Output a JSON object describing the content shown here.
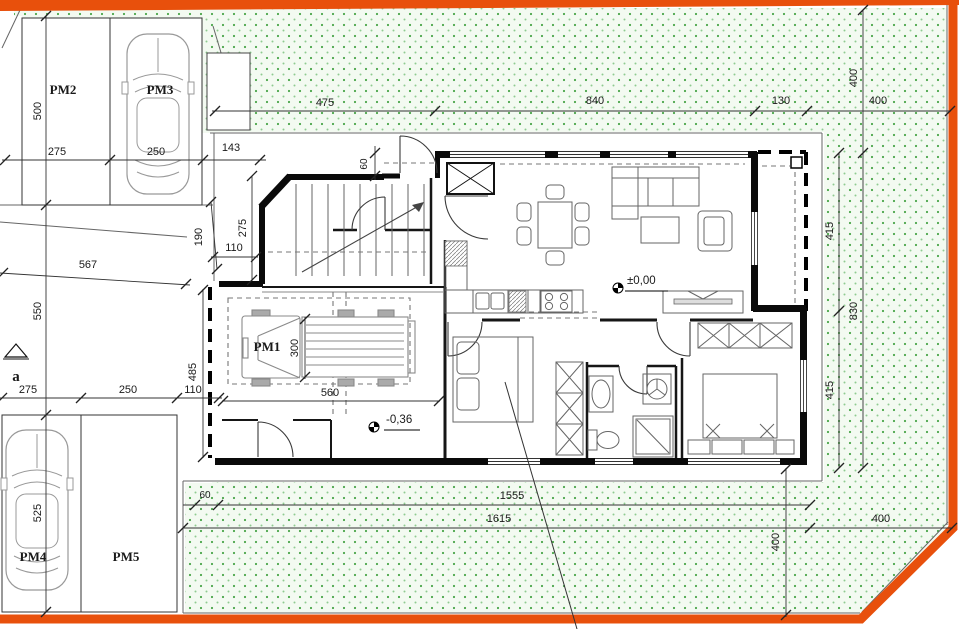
{
  "plan": {
    "parking_labels": {
      "pm1": "PM1",
      "pm2": "PM2",
      "pm3": "PM3",
      "pm4": "PM4",
      "pm5": "PM5"
    },
    "section_marker": "a",
    "levels": {
      "ground": "±0,00",
      "garage": "-0,36"
    },
    "dims": {
      "top": [
        "475",
        "840",
        "130",
        "400"
      ],
      "left_column": [
        "500",
        "550",
        "525"
      ],
      "parking_top": [
        "275",
        "250",
        "143"
      ],
      "parking_bottom": [
        "275",
        "250",
        "110"
      ],
      "house_left": {
        "d190": "190",
        "d275": "275",
        "d110": "110",
        "d567": "567",
        "d485": "485"
      },
      "entry_depth": "60",
      "garage": {
        "width": "560",
        "lane": "300"
      },
      "right_side": {
        "top400": "400",
        "upper415": "415",
        "lower415": "415",
        "total830": "830",
        "bottom400": "400"
      },
      "bottom": {
        "d60": "60",
        "d1555": "1555",
        "d1615": "1615",
        "d400": "400"
      }
    },
    "colors": {
      "boundary": "#e8500c",
      "grass_dot": "#4aa54a",
      "wall": "#0a0a0a"
    }
  }
}
